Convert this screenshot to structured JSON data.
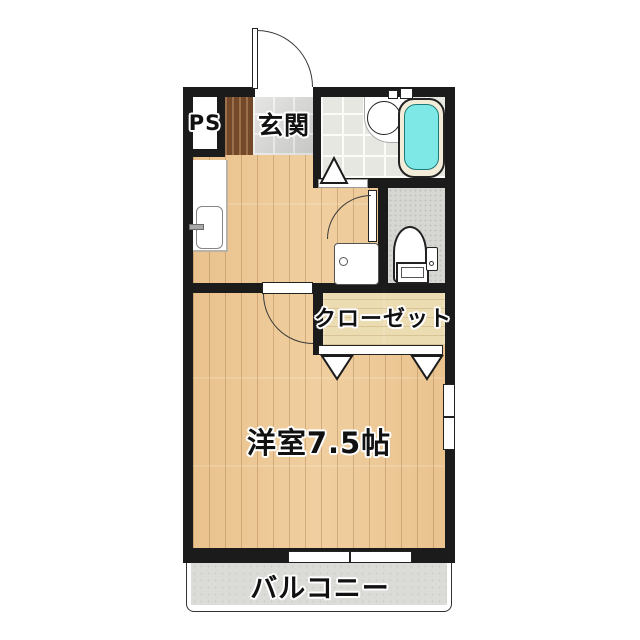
{
  "plan_title": "1K apartment floor plan",
  "rooms": {
    "ps": {
      "label": "PS"
    },
    "genkan": {
      "label": "玄関"
    },
    "closet": {
      "label": "クローゼット"
    },
    "western_room": {
      "label": "洋室7.5帖"
    },
    "balcony": {
      "label": "バルコニー"
    }
  },
  "fixtures": [
    "entrance-door",
    "kitchen-sink",
    "washing-machine-pan",
    "washbasin",
    "bathtub",
    "bathroom-door",
    "toilet",
    "toilet-door",
    "closet-folding-door",
    "room-door",
    "window-south",
    "window-east"
  ],
  "colors": {
    "wall": "#1b1b1b",
    "wood_floor": "#ecc795",
    "closet_floor": "#ecdcb2",
    "entrance_tile": "#d8d8d6",
    "bath_tile": "#e7e7e2",
    "toilet_floor": "#d6d6d3",
    "balcony_floor": "#dbdbd8",
    "step_wood": "#74492a",
    "bathtub_water": "#7de8e6",
    "tub_rim": "#f2ecd9"
  }
}
